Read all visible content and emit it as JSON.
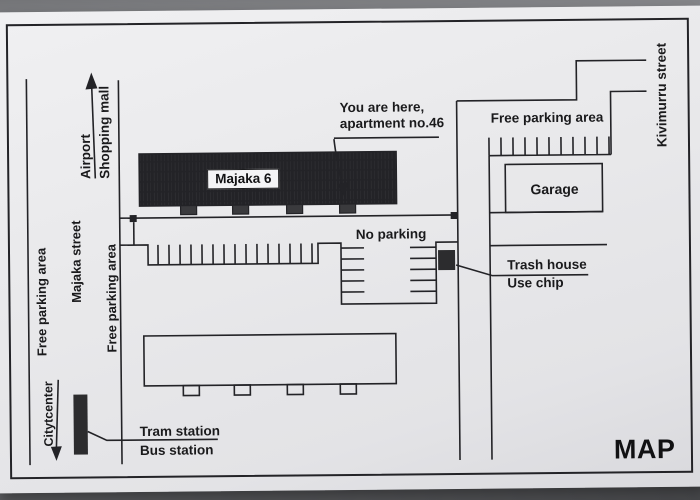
{
  "colors": {
    "background": "#8b8c90",
    "paper": "#e9e9eb",
    "ink": "#232327",
    "building_fill": "#3a3a3d"
  },
  "map": {
    "title": "MAP",
    "streets": {
      "majaka": "Majaka street",
      "kivimurru": "Kivimurru street"
    },
    "directions": {
      "airport": "Airport",
      "shopping_mall": "Shopping mall",
      "citycenter": "Citytcenter"
    },
    "buildings": {
      "majaka6": "Majaka 6",
      "garage": "Garage"
    },
    "parking": {
      "free_left": "Free parking area",
      "free_center": "Free parking area",
      "free_right": "Free parking area",
      "no_parking": "No parking"
    },
    "poi": {
      "you_are_here_1": "You are here,",
      "you_are_here_2": "apartment no.46",
      "trash_1": "Trash house",
      "trash_2": "Use chip",
      "tram": "Tram station",
      "bus": "Bus station"
    }
  }
}
